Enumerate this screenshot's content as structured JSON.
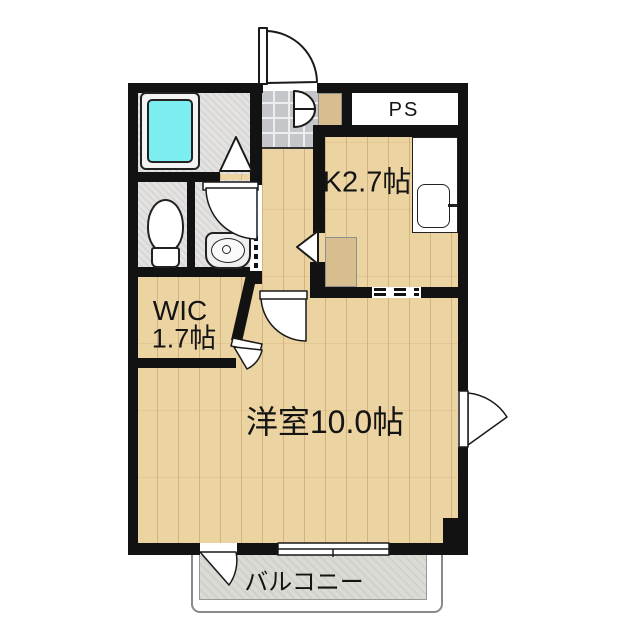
{
  "floorplan": {
    "rooms": {
      "pipe_space": {
        "label": "PS"
      },
      "kitchen": {
        "label": "K2.7帖"
      },
      "wic": {
        "label_line1": "WIC",
        "label_line2": "1.7帖"
      },
      "main_room": {
        "label": "洋室10.0帖"
      },
      "balcony": {
        "label": "バルコニー"
      }
    },
    "colors": {
      "wall": "#121212",
      "wood_floor": "#ecd3a2",
      "wet_area_floor": "#e4e3e2",
      "entry_tile": "#c5c6c9",
      "balcony_floor": "#d9dbd4",
      "bathtub_water": "#7deef0",
      "background": "#ffffff"
    },
    "fixtures": [
      "bathtub",
      "toilet",
      "washbasin",
      "kitchen-counter",
      "kitchen-sink",
      "refrigerator-space",
      "shoe-cabinet",
      "entrance-door",
      "shoe-cabinet-double-door",
      "bathroom-folding-door",
      "washroom-door",
      "accordion-door",
      "kitchen-door",
      "main-room-door",
      "wic-door",
      "balcony-door",
      "sliding-window",
      "side-window"
    ]
  }
}
